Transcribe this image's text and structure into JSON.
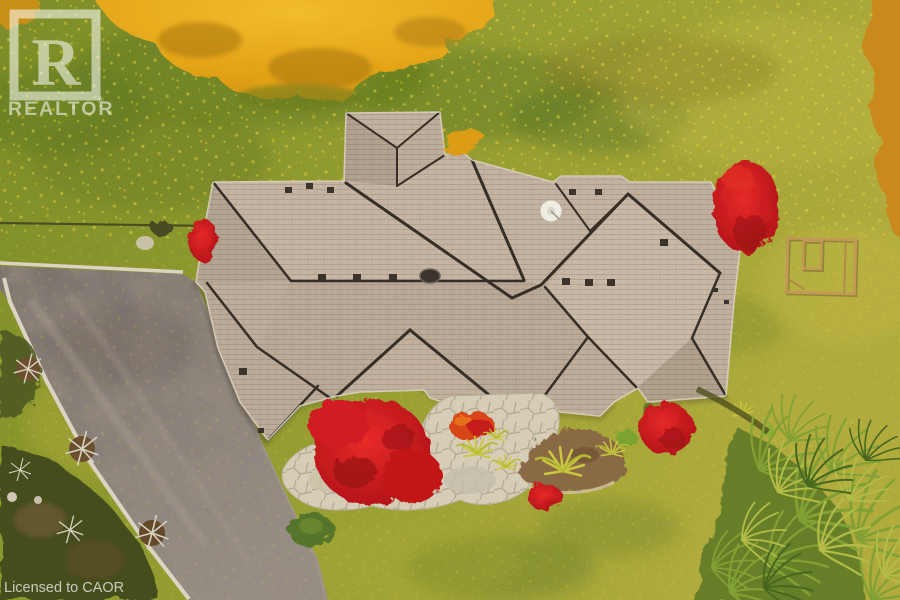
{
  "watermark": {
    "logo_letter": "R",
    "brand": "REALTOR",
    "registered_mark": "®",
    "license_text": "Licensed to CAOR"
  },
  "palette": {
    "lawn": "#939C31",
    "lawn-dark": "#5E7A20",
    "lawn-yellow": "#B7B13E",
    "roof": "#C3B19F",
    "roof-line": "#352F28",
    "maple-red": "#C3161D",
    "canopy-orange": "#E5A51C",
    "driveway": "#8A817B",
    "curb": "#DCD4C2",
    "patio": "#D9D0BA",
    "mulch": "#8A6A44",
    "conifer": "#6E8A2C",
    "watermark": "#FFFFFF"
  }
}
